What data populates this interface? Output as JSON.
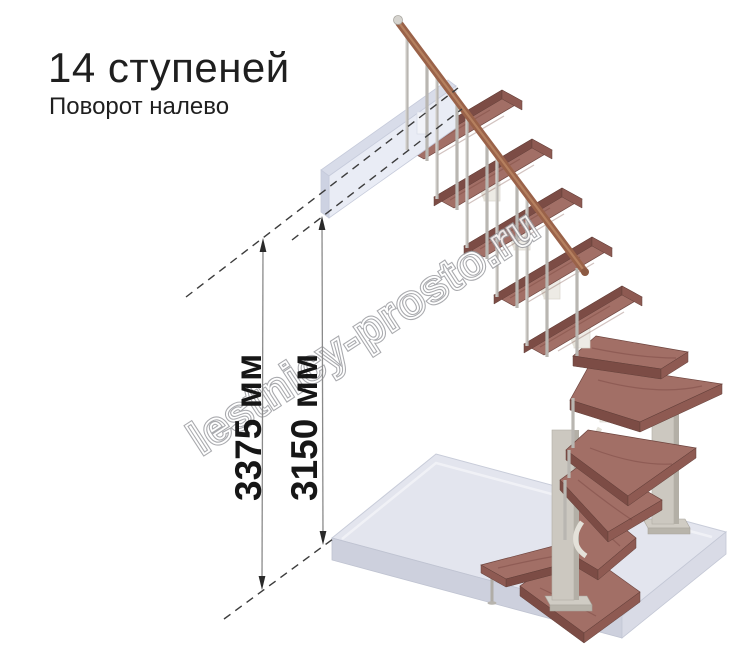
{
  "header": {
    "title": "14 ступеней",
    "subtitle": "Поворот налево"
  },
  "dimensions": {
    "total_height": "3375 мм",
    "ceiling_height": "3150 мм"
  },
  "watermark": {
    "text": "lestnicy-prosto.ru"
  },
  "figure": {
    "subject": "modular-staircase-left-turn",
    "steps_total": 14,
    "colors": {
      "tread_top": "#a26f66",
      "tread_front": "#7c4c45",
      "tread_side": "#8e5a52",
      "handrail": "#9a6249",
      "baluster": "#b9b6b1",
      "spine_module": "#edebe5",
      "support_post": "#ccc8c0",
      "floor_top": "#e3e5ee",
      "floor_front_left": "#cdd0dd",
      "floor_front_right": "#d9dbe6",
      "landing_front": "#e9ecf5",
      "landing_top": "#d8dce9",
      "dimension_line": "#8a8a8a",
      "dimension_arrow": "#2a2a2a",
      "dashed_line": "#3c3c3c",
      "text": "#1f1f1f",
      "watermark_outline": "#9b9ca0"
    }
  }
}
